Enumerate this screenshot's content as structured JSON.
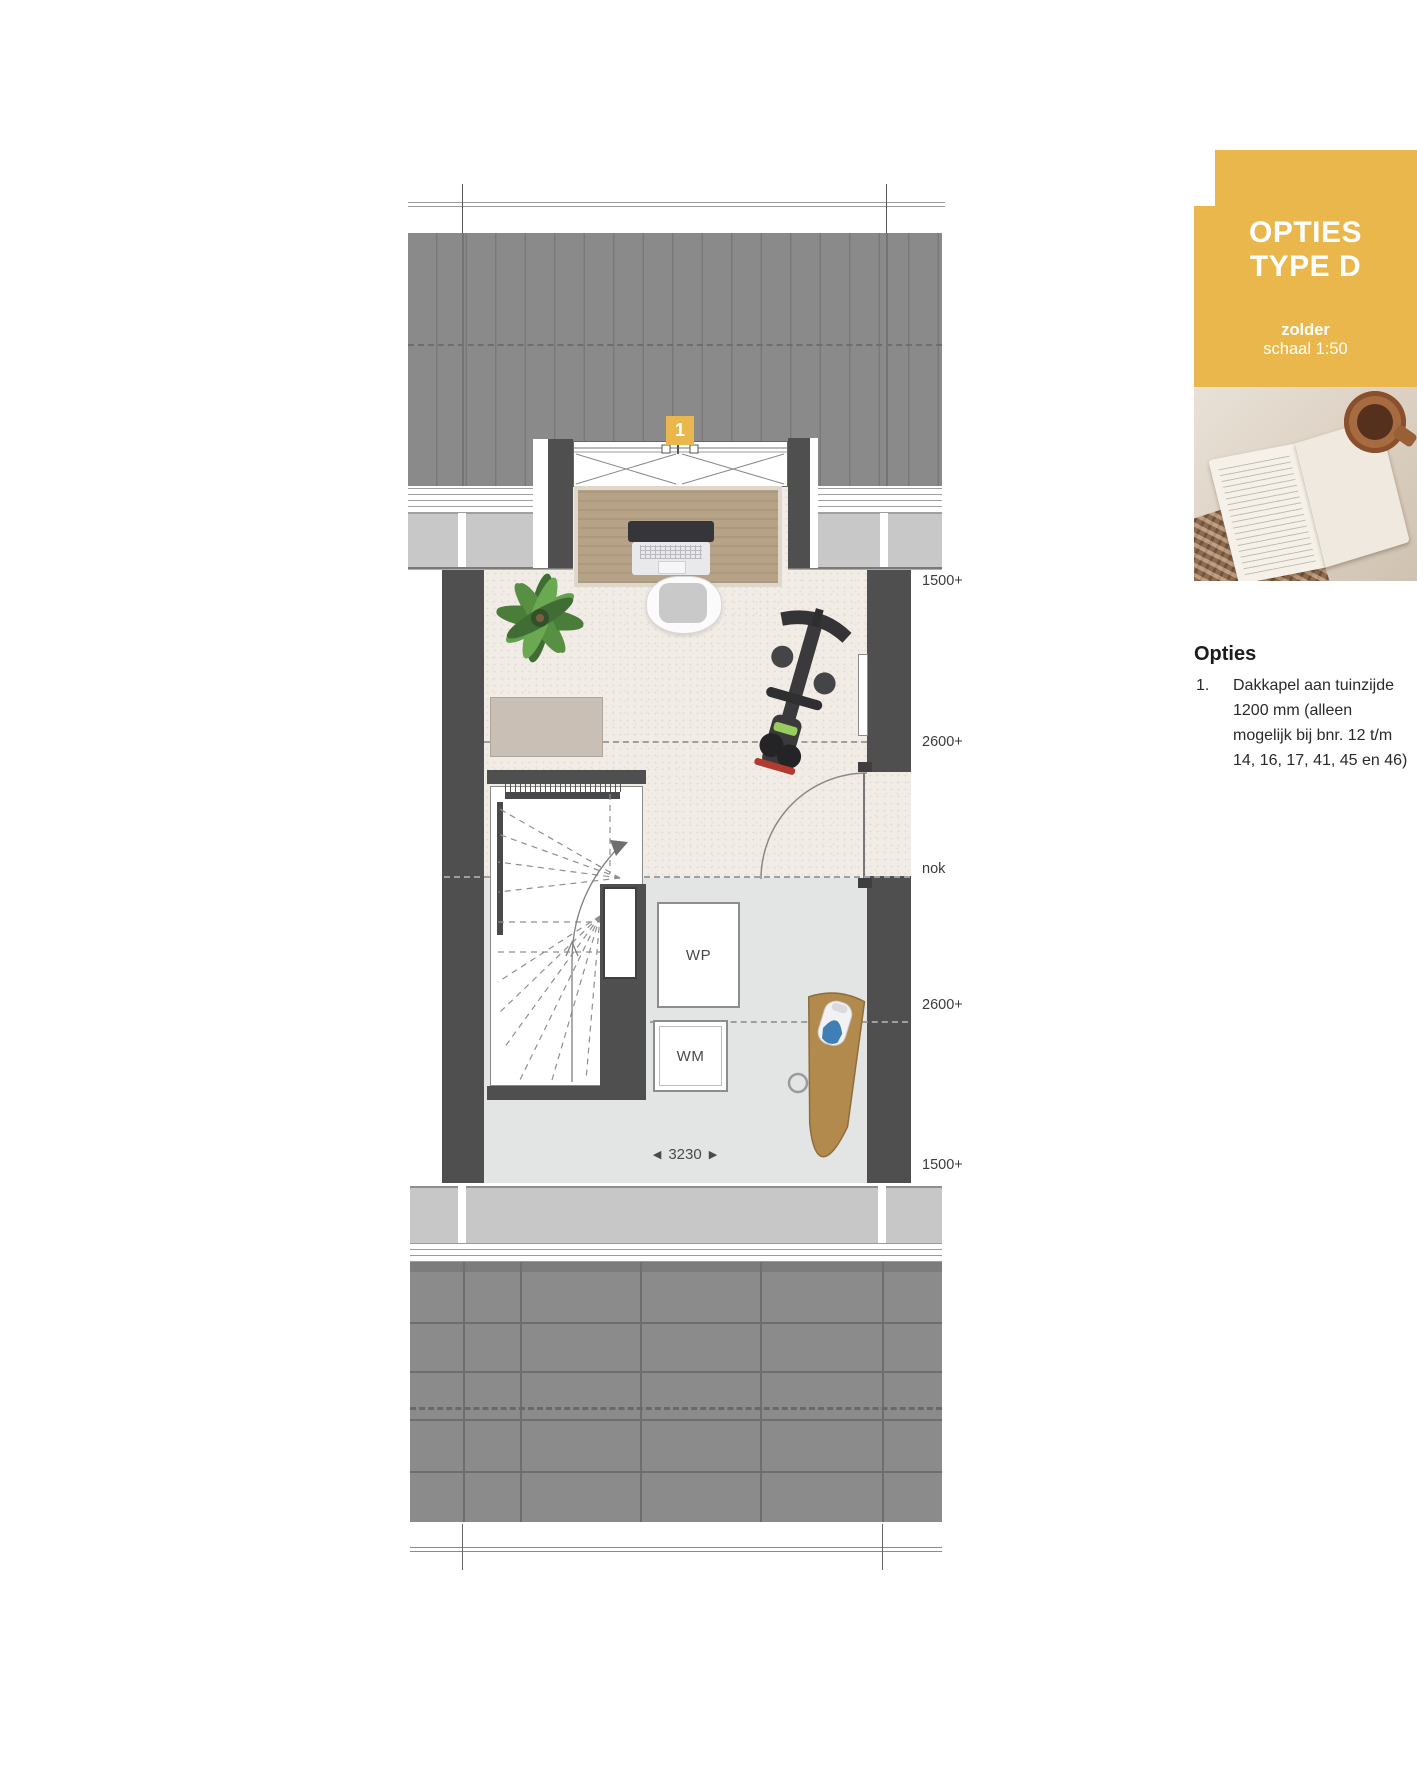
{
  "panel": {
    "title_line1": "OPTIES",
    "title_line2": "TYPE D",
    "subtitle": "zolder",
    "scale": "schaal 1:50",
    "accent_color": "#E9B74B"
  },
  "options": {
    "heading": "Opties",
    "items": [
      {
        "number": "1.",
        "text": "Dakkapel aan tuinzijde 1200 mm (alleen mogelijk bij bnr. 12 t/m 14, 16, 17, 41, 45 en 46)"
      }
    ]
  },
  "plan": {
    "option_marker": "1",
    "height_labels": [
      {
        "text": "1500+"
      },
      {
        "text": "2600+"
      },
      {
        "text": "nok"
      },
      {
        "text": "2600+"
      },
      {
        "text": "1500+"
      }
    ],
    "dimension": {
      "arrow_left": "◀",
      "value": "3230",
      "arrow_right": "▶"
    },
    "appliances": {
      "heat_pump": "WP",
      "washing_machine": "WM"
    },
    "colors": {
      "roof": "#8A8A8A",
      "wall": "#4F4F4F",
      "floor": "#E3E5E4",
      "carpet": "#F1ECE6",
      "wood": "#B5A287"
    }
  }
}
